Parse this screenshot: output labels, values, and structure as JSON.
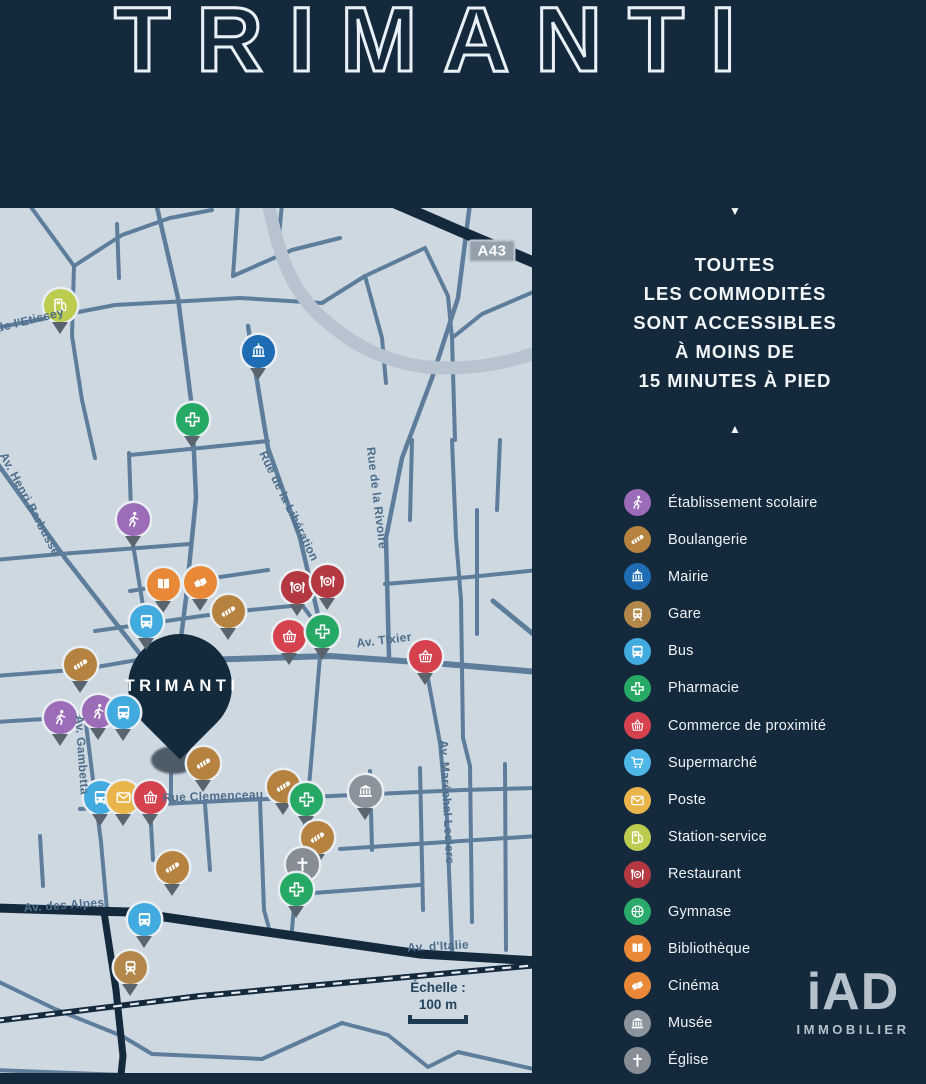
{
  "title": "TRIMANTI",
  "panel": {
    "arrow_down": "▼",
    "arrow_up": "▲",
    "tagline_lines": [
      "TOUTES",
      "LES COMMODITÉS",
      "SONT ACCESSIBLES",
      "À MOINS DE",
      "15 MINUTES À PIED"
    ]
  },
  "legend": {
    "items": [
      {
        "type": "ecole",
        "label": "Établissement scolaire",
        "color": "#9c6cb8"
      },
      {
        "type": "boulangerie",
        "label": "Boulangerie",
        "color": "#b5833f"
      },
      {
        "type": "mairie",
        "label": "Mairie",
        "color": "#1d6cb4"
      },
      {
        "type": "gare",
        "label": "Gare",
        "color": "#b28749"
      },
      {
        "type": "bus",
        "label": "Bus",
        "color": "#41aade"
      },
      {
        "type": "pharmacie",
        "label": "Pharmacie",
        "color": "#27a966"
      },
      {
        "type": "commerce",
        "label": "Commerce de proximité",
        "color": "#d6414e"
      },
      {
        "type": "supermarche",
        "label": "Supermarché",
        "color": "#4fb6e8"
      },
      {
        "type": "poste",
        "label": "Poste",
        "color": "#e9b54a"
      },
      {
        "type": "station",
        "label": "Station-service",
        "color": "#bccc4e"
      },
      {
        "type": "restaurant",
        "label": "Restaurant",
        "color": "#b43842"
      },
      {
        "type": "gymnase",
        "label": "Gymnase",
        "color": "#2aaa6b"
      },
      {
        "type": "bibliotheque",
        "label": "Bibliothèque",
        "color": "#e98938"
      },
      {
        "type": "cinema",
        "label": "Cinéma",
        "color": "#e98938"
      },
      {
        "type": "musee",
        "label": "Musée",
        "color": "#8b949c"
      },
      {
        "type": "eglise",
        "label": "Église",
        "color": "#868d94"
      }
    ]
  },
  "map": {
    "highway_badge": "A43",
    "property_pin": {
      "label": "TRIMANTI",
      "x": 180,
      "y": 478
    },
    "scale": {
      "label": "Échelle :",
      "value": "100 m"
    },
    "street_labels": [
      {
        "text": "de l'Etissey",
        "x": 30,
        "y": 112,
        "rotate": -14
      },
      {
        "text": "Av. Henri Barbusse",
        "x": 30,
        "y": 296,
        "rotate": 62
      },
      {
        "text": "Rue de la Libération",
        "x": 289,
        "y": 298,
        "rotate": 64
      },
      {
        "text": "Rue de la Rivoire",
        "x": 377,
        "y": 290,
        "rotate": 83
      },
      {
        "text": "Av. Tixier",
        "x": 384,
        "y": 432,
        "rotate": -7
      },
      {
        "text": "Av. Gambetta",
        "x": 82,
        "y": 547,
        "rotate": 86
      },
      {
        "text": "Rue Clemenceau",
        "x": 213,
        "y": 588,
        "rotate": -2
      },
      {
        "text": "Av. des Alpes",
        "x": 64,
        "y": 697,
        "rotate": -4
      },
      {
        "text": "Av. Maréchal Leclerc",
        "x": 447,
        "y": 594,
        "rotate": 87
      },
      {
        "text": "Av. d'Italie",
        "x": 438,
        "y": 738,
        "rotate": -3
      }
    ],
    "pins": [
      {
        "type": "station",
        "x": 60,
        "y": 97
      },
      {
        "type": "mairie",
        "x": 258,
        "y": 143
      },
      {
        "type": "pharmacie",
        "x": 192,
        "y": 211
      },
      {
        "type": "ecole",
        "x": 133,
        "y": 311
      },
      {
        "type": "bibliotheque",
        "x": 163,
        "y": 376
      },
      {
        "type": "cinema",
        "x": 200,
        "y": 374
      },
      {
        "type": "boulangerie",
        "x": 228,
        "y": 403
      },
      {
        "type": "bus",
        "x": 146,
        "y": 413
      },
      {
        "type": "restaurant",
        "x": 297,
        "y": 379
      },
      {
        "type": "restaurant",
        "x": 327,
        "y": 373
      },
      {
        "type": "commerce",
        "x": 289,
        "y": 428
      },
      {
        "type": "pharmacie",
        "x": 322,
        "y": 423
      },
      {
        "type": "commerce",
        "x": 425,
        "y": 448
      },
      {
        "type": "boulangerie",
        "x": 80,
        "y": 456
      },
      {
        "type": "ecole",
        "x": 60,
        "y": 509
      },
      {
        "type": "ecole",
        "x": 98,
        "y": 503
      },
      {
        "type": "bus",
        "x": 123,
        "y": 504
      },
      {
        "type": "boulangerie",
        "x": 203,
        "y": 555
      },
      {
        "type": "bus",
        "x": 100,
        "y": 589
      },
      {
        "type": "poste",
        "x": 123,
        "y": 589
      },
      {
        "type": "commerce",
        "x": 150,
        "y": 589
      },
      {
        "type": "boulangerie",
        "x": 283,
        "y": 578
      },
      {
        "type": "pharmacie",
        "x": 306,
        "y": 591
      },
      {
        "type": "musee",
        "x": 365,
        "y": 583
      },
      {
        "type": "boulangerie",
        "x": 317,
        "y": 629
      },
      {
        "type": "eglise",
        "x": 302,
        "y": 656
      },
      {
        "type": "pharmacie",
        "x": 296,
        "y": 681
      },
      {
        "type": "boulangerie",
        "x": 172,
        "y": 659
      },
      {
        "type": "bus",
        "x": 144,
        "y": 711
      },
      {
        "type": "gare",
        "x": 130,
        "y": 759
      }
    ]
  },
  "brand": {
    "name": "iAD",
    "tagline": "IMMOBILIER"
  },
  "colors": {
    "background": "#14293c",
    "map_background": "#cdd8e1",
    "street": "#5e7d9b",
    "major_road_dark": "#14293c",
    "wide_band": "#b7c3cf",
    "street_label": "#4e6d8b",
    "pin_ring": "#e9eef3",
    "pin_tail": "#59646e",
    "text_light": "#f2f6f8"
  }
}
